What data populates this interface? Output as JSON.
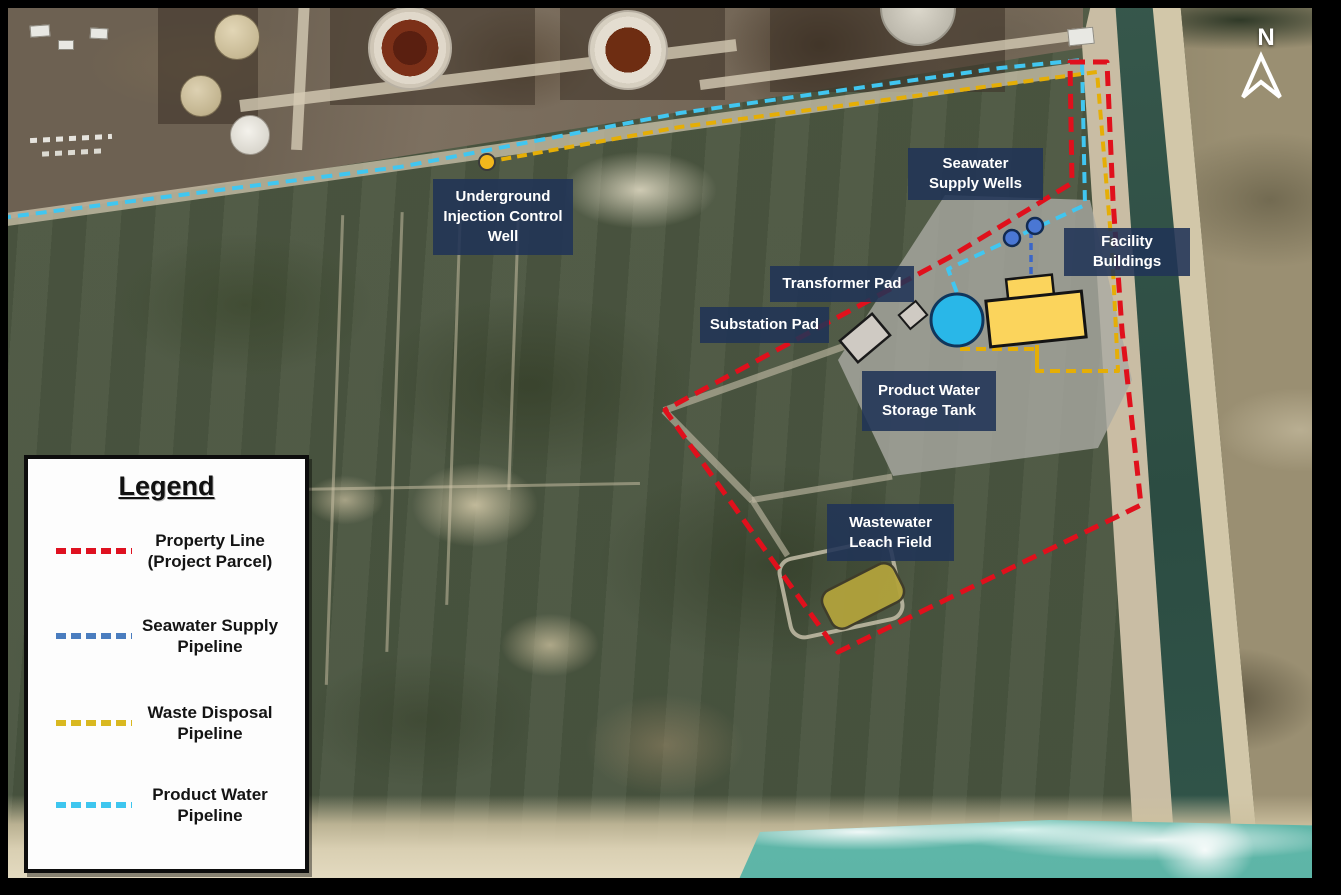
{
  "north_label": "N",
  "map_labels": [
    {
      "id": "underground-injection-control-well",
      "text": "Underground\nInjection Control\nWell"
    },
    {
      "id": "seawater-supply-wells",
      "text": "Seawater\nSupply Wells"
    },
    {
      "id": "facility-buildings",
      "text": "Facility\nBuildings"
    },
    {
      "id": "transformer-pad",
      "text": "Transformer Pad"
    },
    {
      "id": "substation-pad",
      "text": "Substation Pad"
    },
    {
      "id": "product-water-storage-tank",
      "text": "Product Water\nStorage Tank"
    },
    {
      "id": "wastewater-leach-field",
      "text": "Wastewater\nLeach Field"
    }
  ],
  "legend": {
    "title": "Legend",
    "items": [
      {
        "label": "Property Line\n(Project Parcel)",
        "color": "#df1120"
      },
      {
        "label": "Seawater Supply\nPipeline",
        "color": "#4a7dbf"
      },
      {
        "label": "Waste Disposal\nPipeline",
        "color": "#d9b820"
      },
      {
        "label": "Product Water\nPipeline",
        "color": "#3ec6ef"
      }
    ]
  },
  "features": {
    "property_line_color": "#e0101c",
    "seawater_pipeline_color": "#3a66c8",
    "waste_pipeline_color": "#e5ae06",
    "product_pipeline_color": "#41c6f0",
    "well_fill": "#4a77d4",
    "injection_well_fill": "#f2b71c",
    "storage_tank_fill": "#29b7e8",
    "building_fill": "#fbd45c",
    "pad_fill": "#cfcac3",
    "leach_field_fill": "#b2a33c",
    "label_bg": "rgba(32,51,86,0.88)"
  }
}
